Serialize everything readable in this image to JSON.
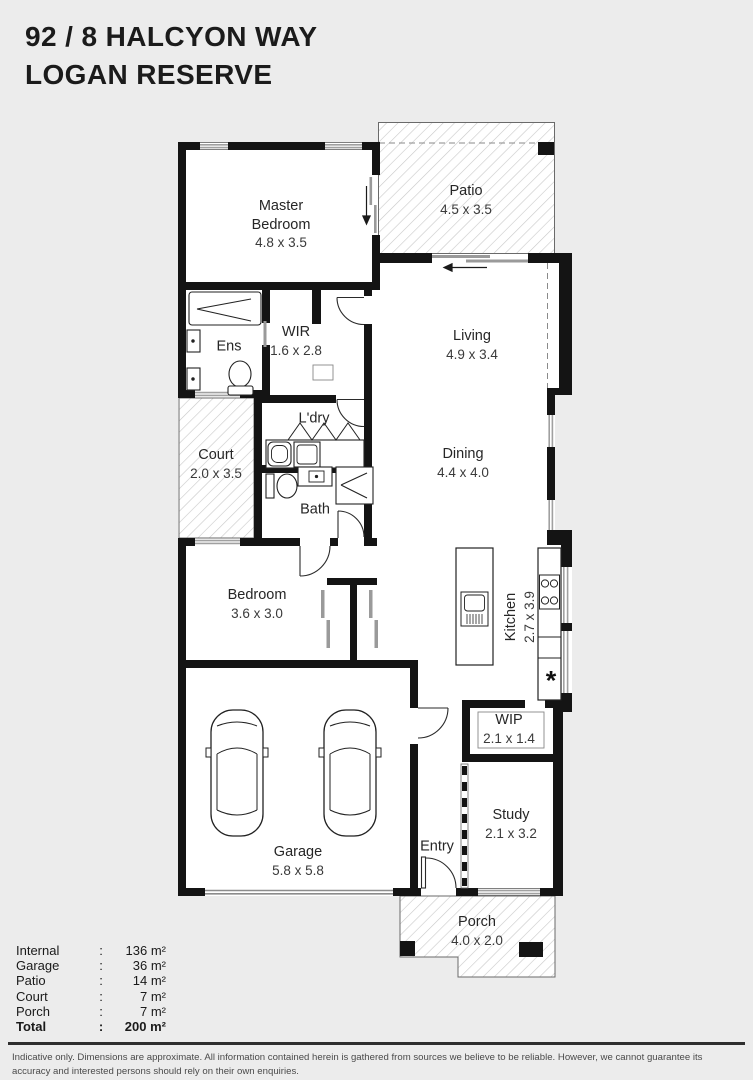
{
  "header": {
    "line1": "92 / 8 HALCYON WAY",
    "line2": "LOGAN RESERVE"
  },
  "rooms": [
    {
      "id": "master-bedroom",
      "name": "Master Bedroom",
      "dims": "4.8 x 3.5"
    },
    {
      "id": "patio",
      "name": "Patio",
      "dims": "4.5 x 3.5"
    },
    {
      "id": "wir",
      "name": "WIR",
      "dims": "1.6 x 2.8"
    },
    {
      "id": "ens",
      "name": "Ens",
      "dims": ""
    },
    {
      "id": "living",
      "name": "Living",
      "dims": "4.9 x 3.4"
    },
    {
      "id": "ldry",
      "name": "L'dry",
      "dims": ""
    },
    {
      "id": "court",
      "name": "Court",
      "dims": "2.0 x 3.5"
    },
    {
      "id": "dining",
      "name": "Dining",
      "dims": "4.4 x 4.0"
    },
    {
      "id": "bath",
      "name": "Bath",
      "dims": ""
    },
    {
      "id": "bedroom",
      "name": "Bedroom",
      "dims": "3.6 x 3.0"
    },
    {
      "id": "kitchen",
      "name": "Kitchen",
      "dims": "2.7 x 3.9"
    },
    {
      "id": "wip",
      "name": "WIP",
      "dims": "2.1 x 1.4"
    },
    {
      "id": "study",
      "name": "Study",
      "dims": "2.1 x 3.2"
    },
    {
      "id": "entry",
      "name": "Entry",
      "dims": ""
    },
    {
      "id": "garage",
      "name": "Garage",
      "dims": "5.8 x 5.8"
    },
    {
      "id": "porch",
      "name": "Porch",
      "dims": "4.0 x 2.0"
    }
  ],
  "symbols": {
    "fridge_marker": "*"
  },
  "legend": {
    "colon": ":",
    "rows": [
      {
        "label": "Internal",
        "value": "136 m²"
      },
      {
        "label": "Garage",
        "value": "36 m²"
      },
      {
        "label": "Patio",
        "value": "14 m²"
      },
      {
        "label": "Court",
        "value": "7 m²"
      },
      {
        "label": "Porch",
        "value": "7 m²"
      },
      {
        "label": "Total",
        "value": "200 m²"
      }
    ]
  },
  "disclaimer": "Indicative only. Dimensions are approximate. All information contained herein is gathered from sources we believe to be reliable. However, we cannot guarantee its accuracy and interested persons should rely on their own enquiries.",
  "colors": {
    "background": "#ececec",
    "walls": "#141414",
    "hatch_line": "#c8c8c8",
    "window": "#a0a0a0",
    "text": "#262626"
  }
}
